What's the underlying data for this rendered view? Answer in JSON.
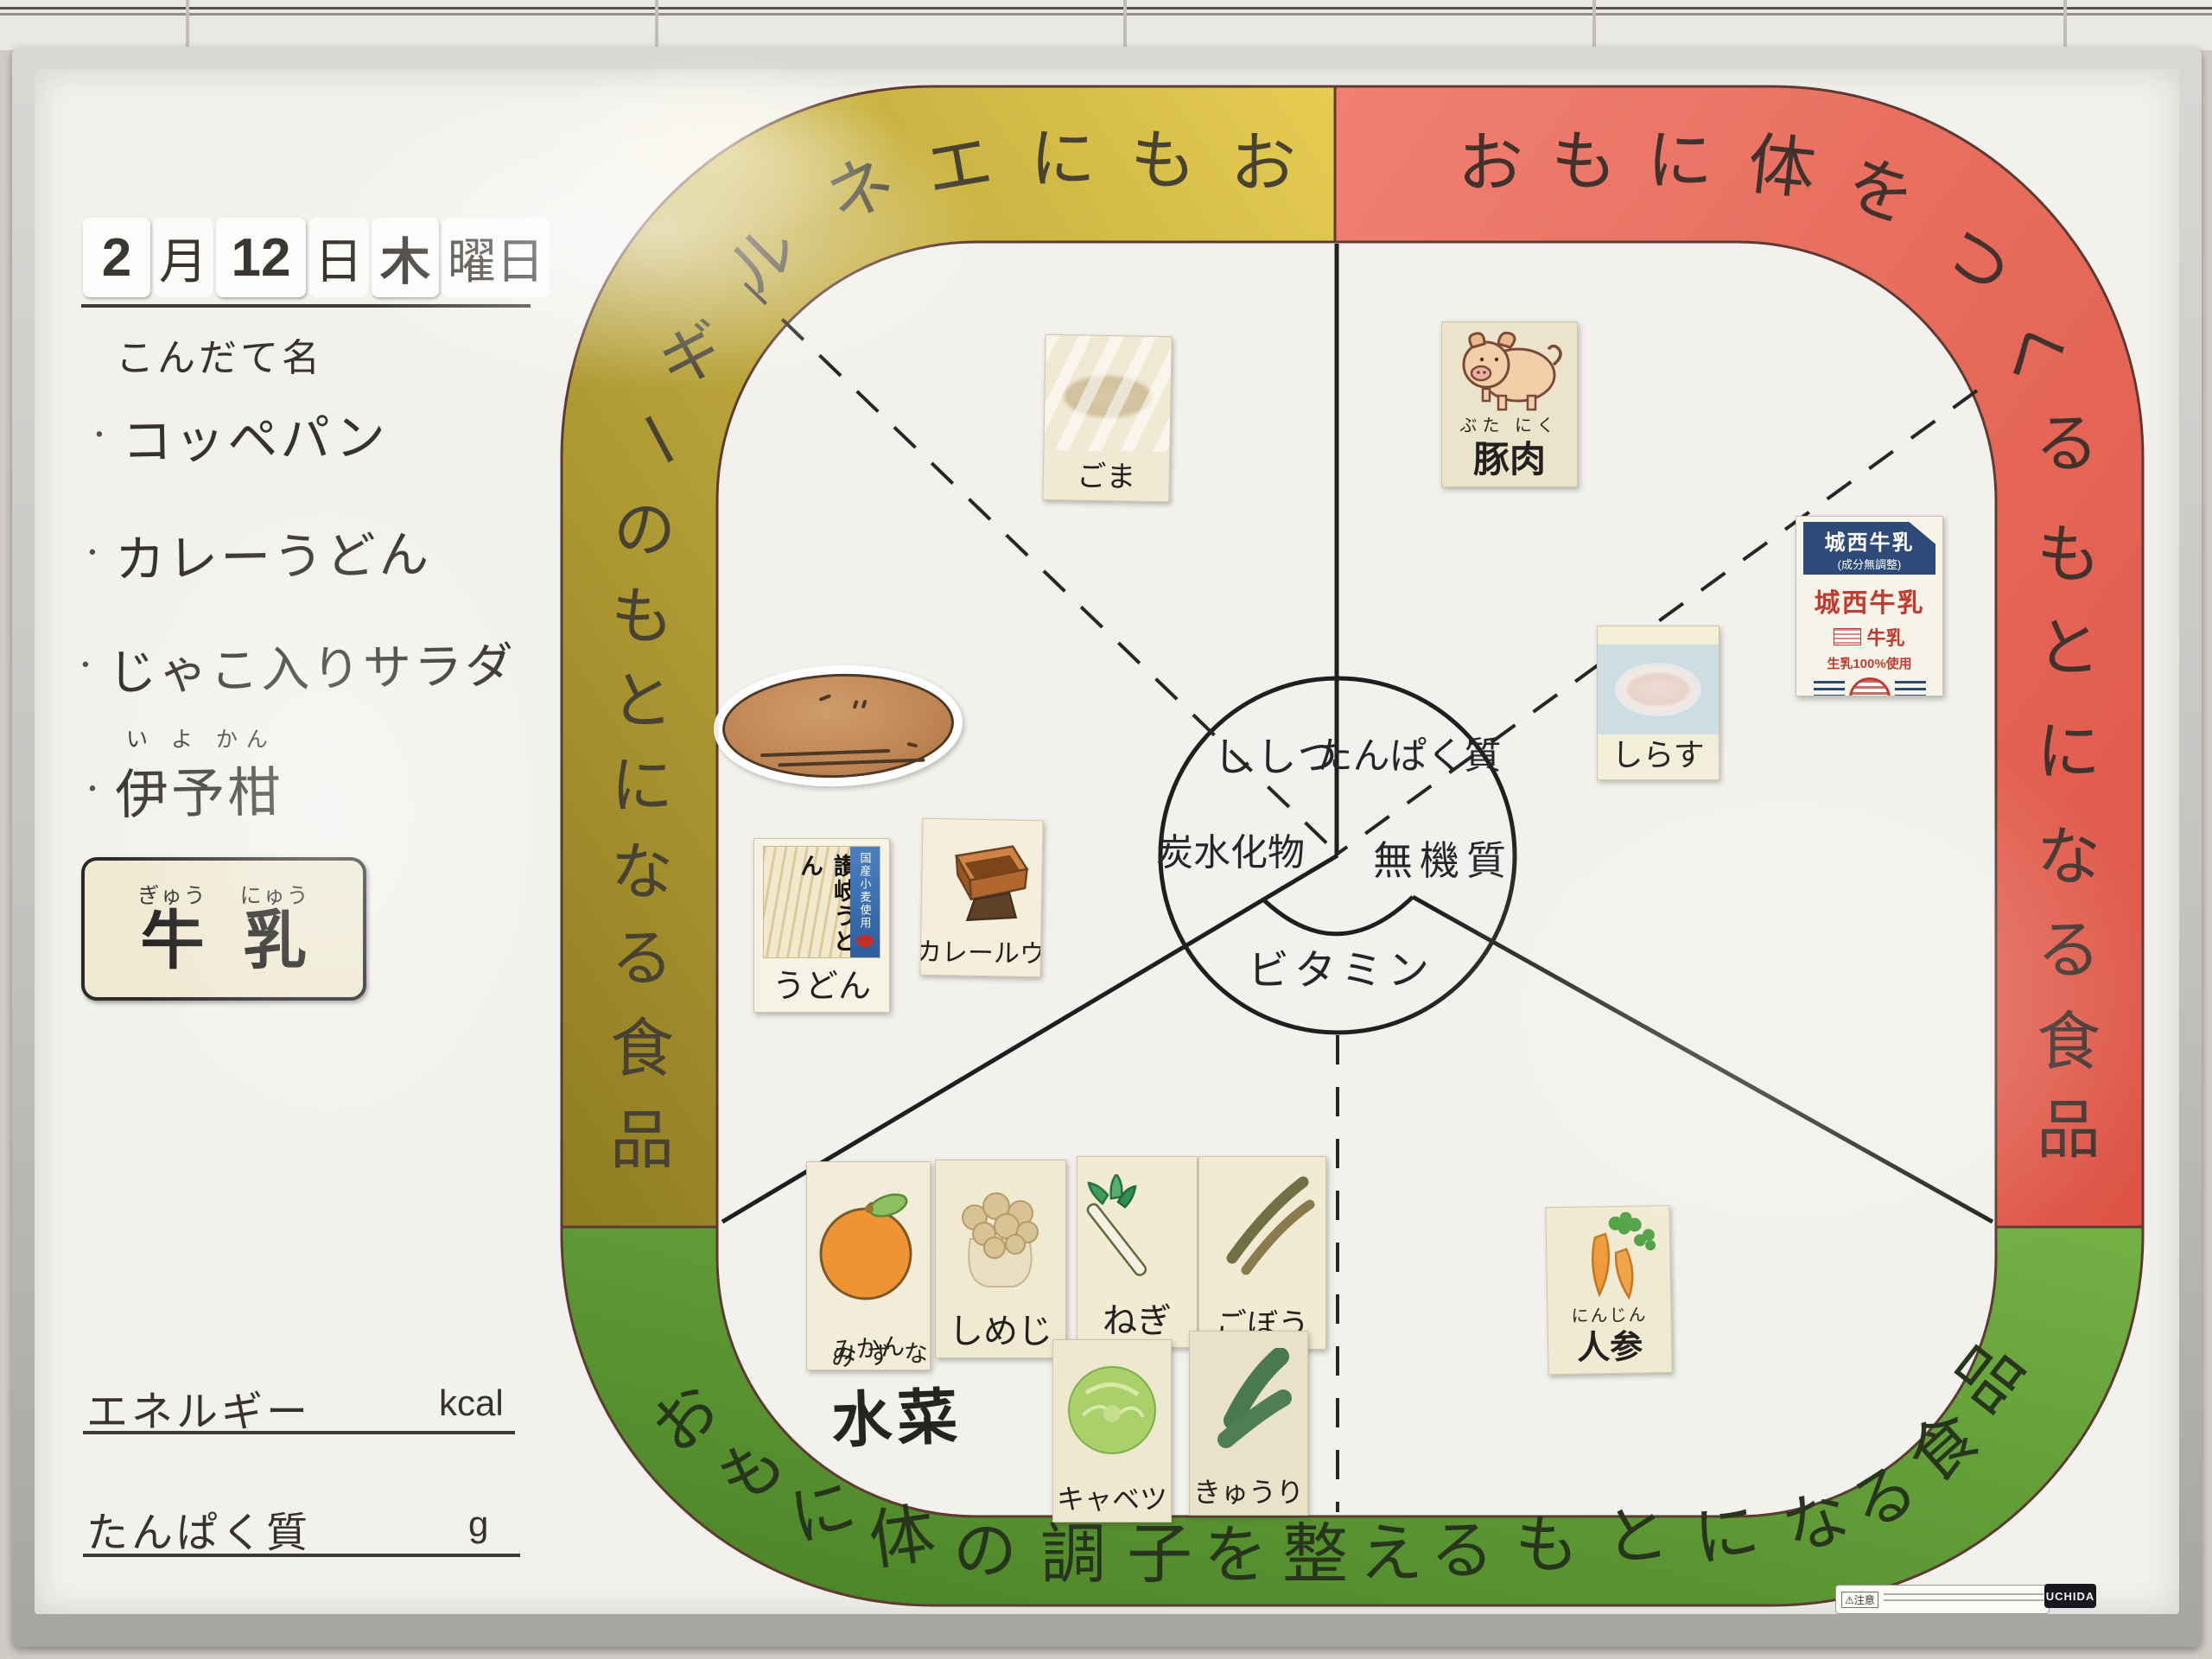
{
  "date": {
    "month_value": "2",
    "month_unit": "月",
    "day_value": "12",
    "day_unit": "日",
    "weekday": "木",
    "weekday_unit": "曜日"
  },
  "menu": {
    "heading": "こんだて名",
    "bullet": "・",
    "items": [
      {
        "text": "コッペパン"
      },
      {
        "text": "カレーうどん"
      },
      {
        "text": "じゃこ入りサラダ"
      },
      {
        "text": "伊予柑",
        "furigana": "い よ かん"
      }
    ]
  },
  "milk_card": {
    "chars": [
      {
        "kana": "ぎゅう",
        "kanji": "牛"
      },
      {
        "kana": "にゅう",
        "kanji": "乳"
      }
    ]
  },
  "nutrition_fields": {
    "energy": {
      "label": "エネルギー",
      "unit": "kcal",
      "value": ""
    },
    "protein": {
      "label": "たんぱく質",
      "unit": "g",
      "value": ""
    }
  },
  "bands": {
    "yellow": {
      "text": "おもにエネルギーのもとになる食品",
      "color_light": "#e6cc52",
      "color_dark": "#8f7c22"
    },
    "red": {
      "text": "おもに体をつくるもとになる食品",
      "color_light": "#f08071",
      "color_dark": "#dd5445"
    },
    "green": {
      "text": "おもに体の調子を整えるもとになる食品",
      "color_light": "#73b145",
      "color_dark": "#4a8226"
    }
  },
  "nutrients": {
    "fat": "ししつ",
    "protein": "たんぱく質",
    "carbohydrate": "炭水化物",
    "mineral": "無機質",
    "vitamin": "ビタミン"
  },
  "foods": {
    "sesame": {
      "label": "ごま"
    },
    "pork": {
      "furigana": "ぶた にく",
      "label": "豚肉"
    },
    "milk_carton": {
      "header": "城西牛乳",
      "subheader": "(成分無調整)",
      "brand": "城西牛乳",
      "type_label": "牛乳",
      "note": "生乳100%使用",
      "storage": "要冷蔵10℃以下 200ml"
    },
    "shirasu": {
      "label": "しらす"
    },
    "udon": {
      "package_text": "讃岐うどん",
      "package_side_text": "国産小麦使用",
      "label": "うどん"
    },
    "curry_roux": {
      "label": "カレールウ"
    },
    "mikan": {
      "label": "みかん"
    },
    "shimeji": {
      "label": "しめじ"
    },
    "negi": {
      "label": "ねぎ"
    },
    "gobo": {
      "label": "ごぼう"
    },
    "mizuna": {
      "furigana": "みずな",
      "label": "水菜"
    },
    "cabbage": {
      "label": "キャベツ"
    },
    "cucumber": {
      "label": "きゅうり"
    },
    "carrot": {
      "furigana": "にんじん",
      "label": "人参"
    }
  },
  "footer": {
    "caution": "注意",
    "brand": "UCHIDA"
  }
}
